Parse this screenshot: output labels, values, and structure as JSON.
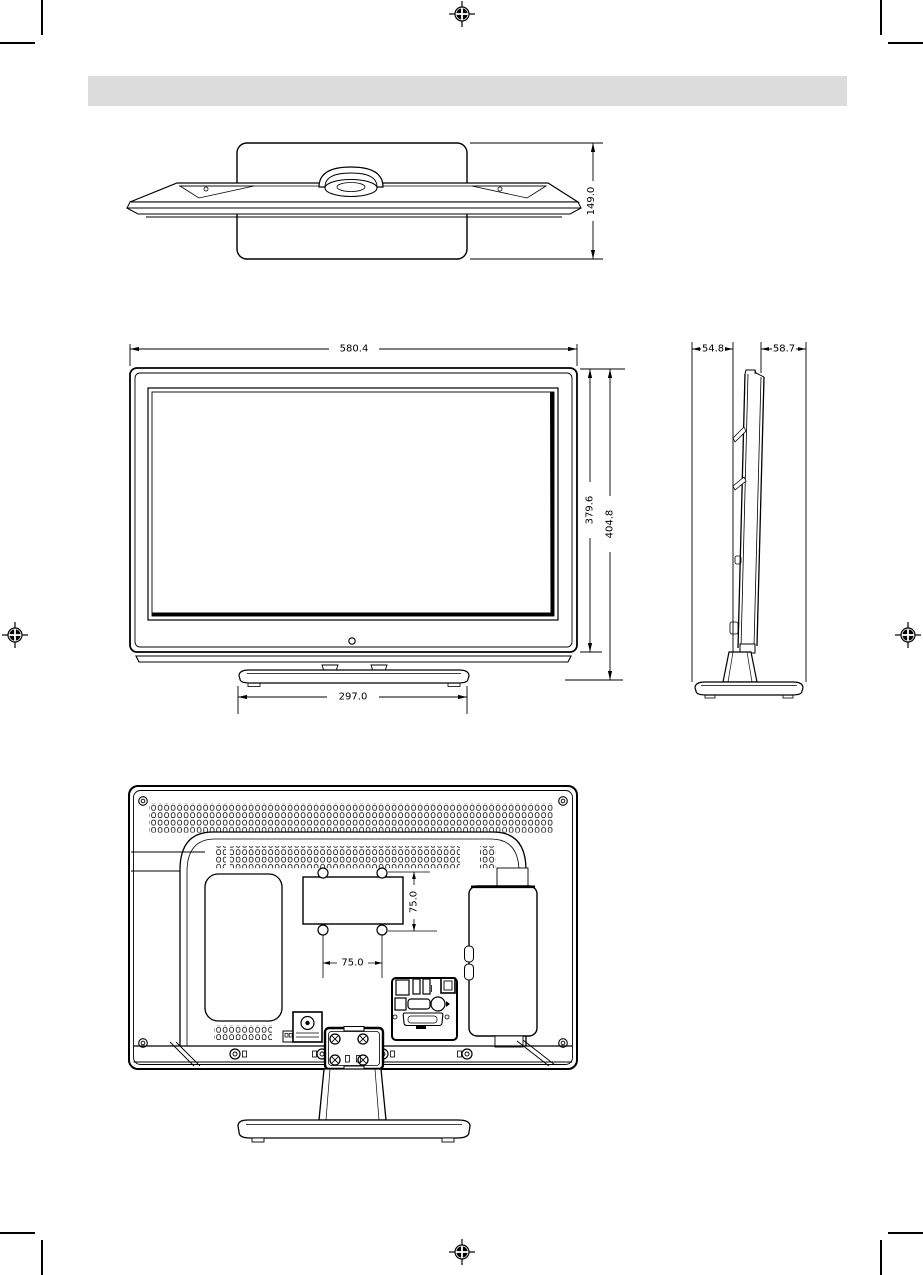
{
  "page": {
    "background_color": "#ffffff",
    "line_color": "#000000",
    "header_bar_color": "#dcdcdc"
  },
  "dimensions_mm": {
    "top_view_depth": "149.0",
    "front_width": "580.4",
    "front_height_panel": "379.6",
    "front_height_total": "404.8",
    "stand_base_width": "297.0",
    "side_depth_front": "54.8",
    "side_depth_rear": "58.7",
    "vesa_pitch_vertical": "75.0",
    "vesa_pitch_horizontal": "75.0"
  }
}
